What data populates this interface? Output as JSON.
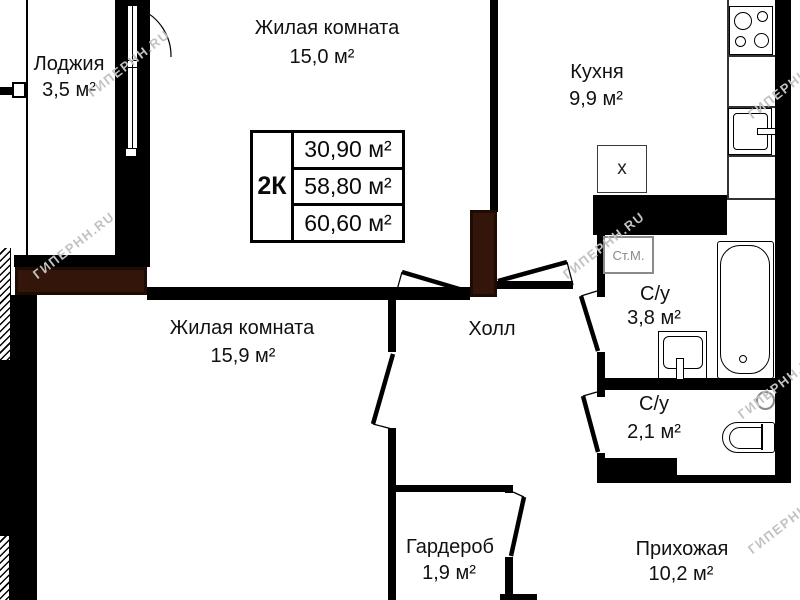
{
  "watermark": "ГИПЕРНН.RU",
  "summary_table": {
    "apartment_type": "2К",
    "living_area": "30,90 м²",
    "reduced_total_area": "58,80 м²",
    "total_area": "60,60 м²"
  },
  "rooms": {
    "living1": {
      "name": "Жилая комната",
      "area": "15,0 м²"
    },
    "loggia": {
      "name": "Лоджия",
      "area": "3,5 м²"
    },
    "kitchen": {
      "name": "Кухня",
      "area": "9,9 м²"
    },
    "living2": {
      "name": "Жилая комната",
      "area": "15,9 м²"
    },
    "hall": {
      "name": "Холл"
    },
    "bathroom": {
      "name": "С/у",
      "area": "3,8 м²"
    },
    "toilet": {
      "name": "С/у",
      "area": "2,1 м²"
    },
    "wardrobe": {
      "name": "Гардероб",
      "area": "1,9 м²"
    },
    "entry": {
      "name": "Прихожая",
      "area": "10,2 м²"
    }
  },
  "fixtures": {
    "washing_machine_label": "Ст.М.",
    "kitchen_box_label": "х"
  }
}
